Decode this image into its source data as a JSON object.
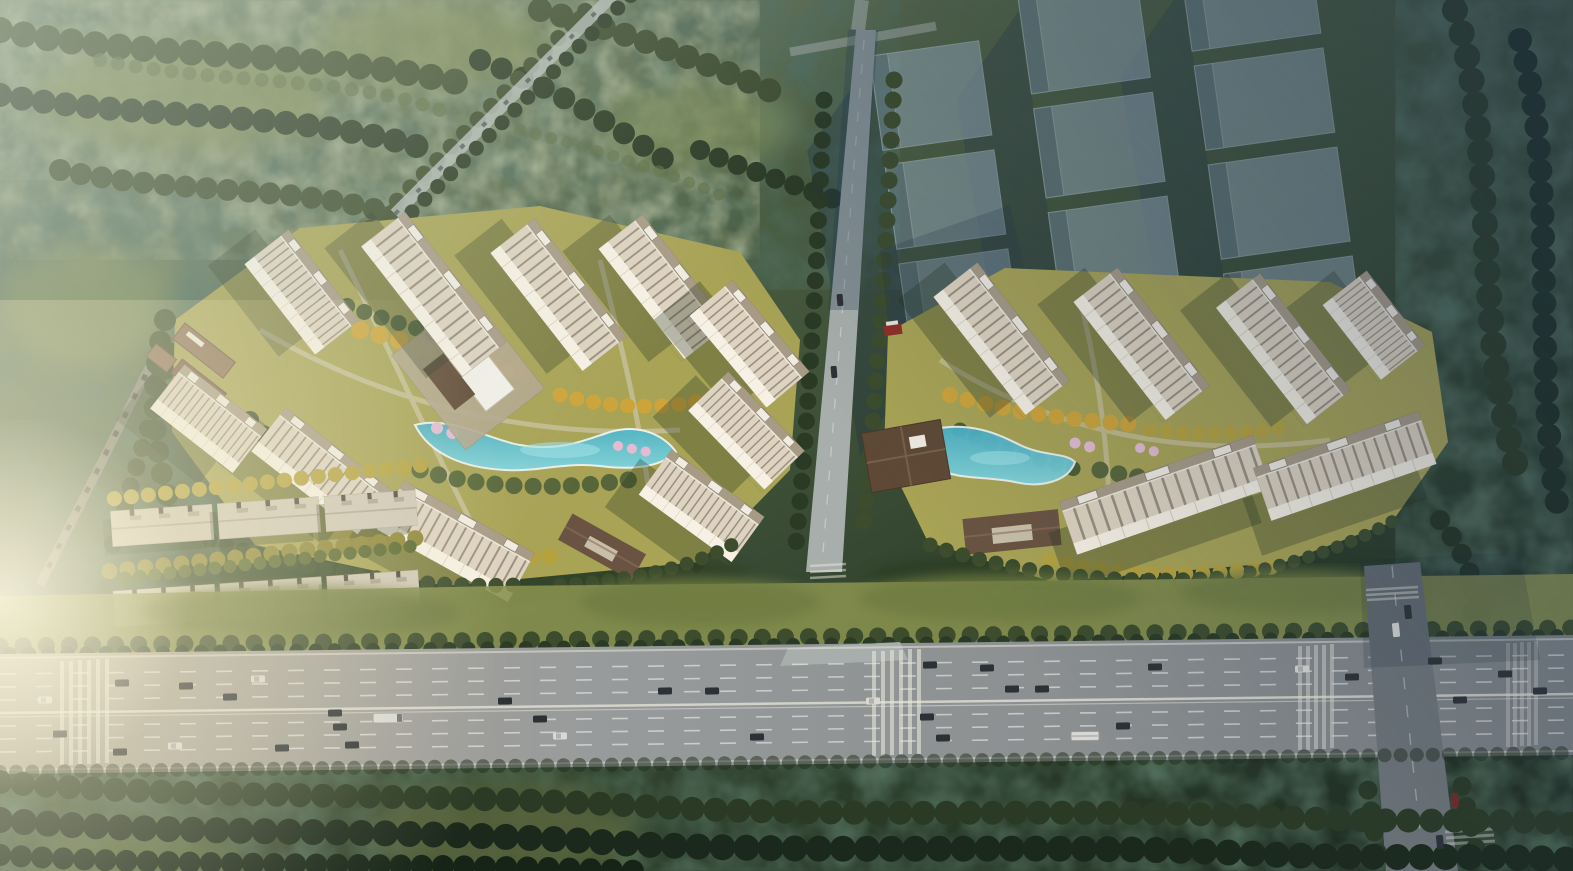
{
  "scene": {
    "caption": "Hazy aerial rendering of a two-compound residential development beside a tree-lined eight-lane boulevard, with translucent future-phase tower massing at the upper right and warm sun glare from the left.",
    "counts": {
      "residential_compounds": 2,
      "towers_left_compound": 10,
      "towers_right_compound": 6,
      "future_phase_blocks": 11,
      "industrial_sheds": 6,
      "landscape_pools": 2,
      "boulevard_lanes": 8,
      "boulevard_crosswalks": 4,
      "vehicles": 41
    }
  },
  "colors": {
    "bg_top": "#7f8f6d",
    "bg_mid": "#44583c",
    "bg_deep": "#1c2a1e",
    "meadow": "#7b8a55",
    "tree_dark": "#3c4c2d",
    "tree_deep": "#2a3a24",
    "tree_green": "#4d5d33",
    "tree_sage": "#57663a",
    "tree_olive": "#8c8436",
    "autumn_gold": "#cda43a",
    "autumn_bright": "#dbb844",
    "autumn_olive": "#b5a23f",
    "blossom": "#e3bcd2",
    "lawn": "#a8a355",
    "pool_top": "#49b0c4",
    "pool_low": "#82d6df",
    "pool_edge": "#eef4f0",
    "tower_body": "#ded3c0",
    "tower_rib": "#5f5749",
    "tower_facade": "#f6f1e4",
    "tower_roof": "#a89b86",
    "tower_trim": "#f1ece1",
    "tower_shadow": "#22311f",
    "pavilion_roof": "#5f4936",
    "gate_roof": "#6a5342",
    "shed_roof": "#d0c8b7",
    "shed_ridge": "#b2a995",
    "road_sunlit": "#b0a99a",
    "road_mid": "#989b9b",
    "road_dark": "#7d8285",
    "road_top": "#a7aeab",
    "road_marking": "#ffffff",
    "median": "#e8e6da",
    "sidewalk": "#d9d3c4",
    "side_road": "#70767a",
    "ghost_fill": "#9cb0c0",
    "ghost_face": "#70879c",
    "ghost_edge": "#c2cfda",
    "ghost_shadow": "#1f3349",
    "car_white": "#d8d8d4",
    "car_dark": "#2c3135",
    "car_red": "#722a26",
    "glare": "#fff1c8",
    "haze": "#d5ddce",
    "wash_blue": "#263a54"
  }
}
